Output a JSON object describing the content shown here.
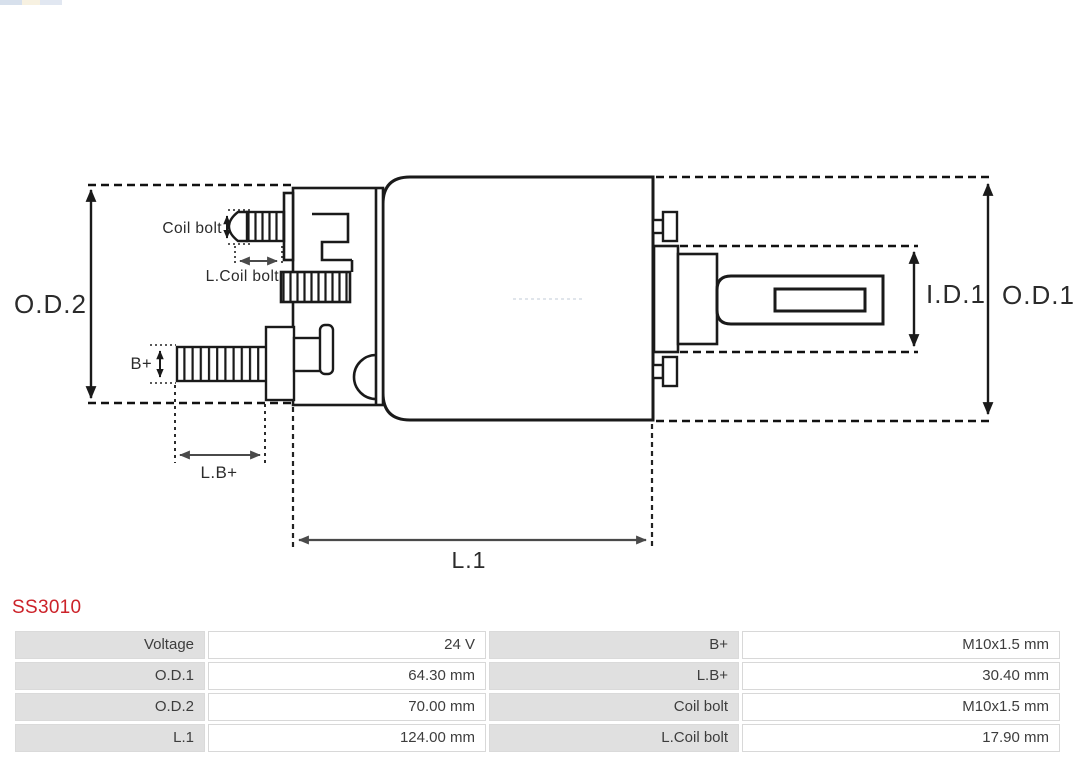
{
  "product": {
    "code": "SS3010"
  },
  "colors": {
    "product_code": "#cc2229",
    "diagram_line": "#1a1a1a",
    "dim_arrow_gray": "#4a4a4a",
    "table_label_bg": "#e0e0e0",
    "table_border": "#d8d8d8",
    "table_text": "#3d3d3d"
  },
  "diagram": {
    "dimension_labels": {
      "od2": "O.D.2",
      "od1": "O.D.1",
      "id1": "I.D.1",
      "l1": "L.1",
      "coil_bolt": "Coil bolt",
      "l_coil_bolt": "L.Coil bolt",
      "b_plus": "B+",
      "l_b_plus": "L.B+"
    }
  },
  "spec_table": {
    "rows": [
      {
        "label_left": "Voltage",
        "value_left": "24 V",
        "label_right": "B+",
        "value_right": "M10x1.5 mm"
      },
      {
        "label_left": "O.D.1",
        "value_left": "64.30 mm",
        "label_right": "L.B+",
        "value_right": "30.40 mm"
      },
      {
        "label_left": "O.D.2",
        "value_left": "70.00 mm",
        "label_right": "Coil bolt",
        "value_right": "M10x1.5 mm"
      },
      {
        "label_left": "L.1",
        "value_left": "124.00 mm",
        "label_right": "L.Coil bolt",
        "value_right": "17.90 mm"
      }
    ]
  }
}
